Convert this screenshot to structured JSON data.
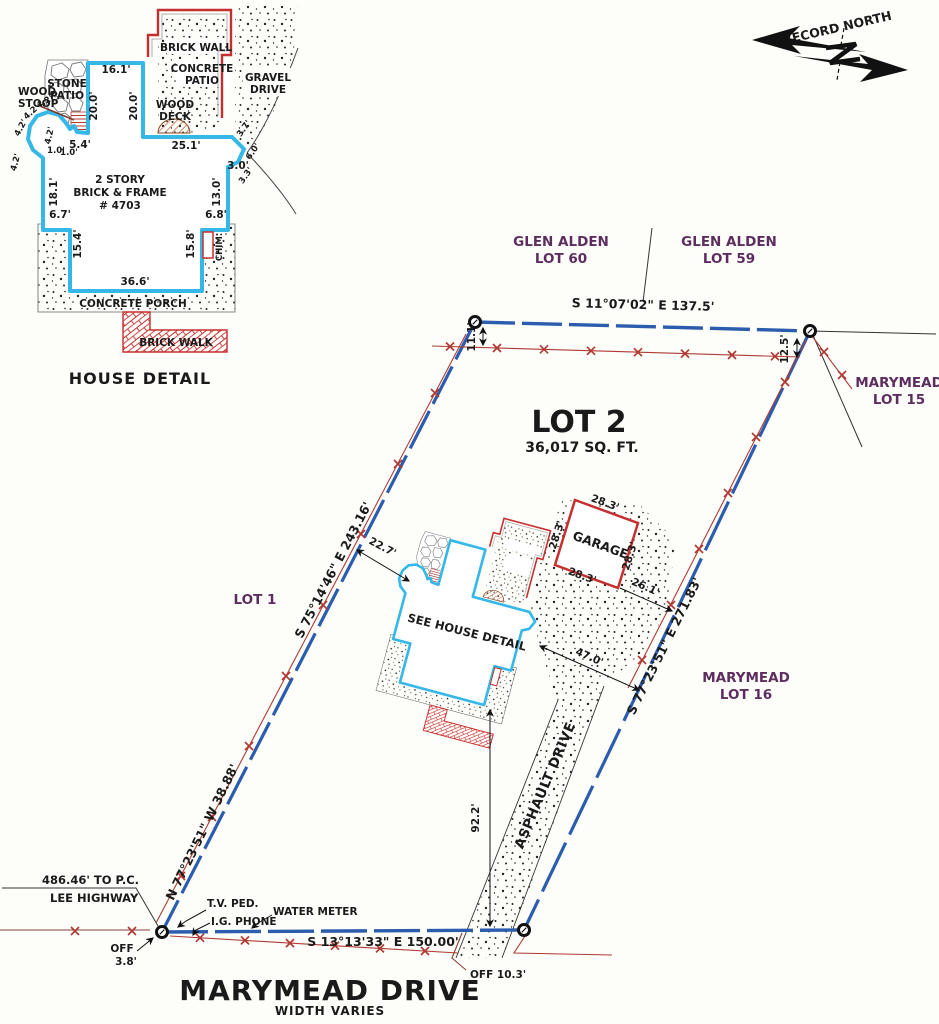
{
  "colors": {
    "boundary": "#2b5cad",
    "fence": "#b03a33",
    "house_outline": "#35b8e8",
    "brick": "#c62f2f",
    "lot_label": "#5c2d5e"
  },
  "hd": {
    "title": "HOUSE DETAIL",
    "brick_wall": "BRICK WALL",
    "concrete": "CONCRETE",
    "patio": "PATIO",
    "gravel": "GRAVEL",
    "drive": "DRIVE",
    "stone": "STONE",
    "wood": "WOOD",
    "stoop": "STOOP",
    "deck": "DECK",
    "porch": "CONCRETE PORCH",
    "walk": "BRICK WALK",
    "chim": "CHIM.",
    "story1": "2 STORY",
    "story2": "BRICK & FRAME",
    "story3": "# 4703",
    "d16": "16.1'",
    "d20": "20.0'",
    "d25": "25.1'",
    "d54": "5.4'",
    "d42": "4.2'",
    "d10": "1.0'",
    "d181": "18.1'",
    "d130": "13.0'",
    "d30": "3.0'",
    "d33": "3.3'",
    "d60": "6.0'",
    "d37": "3.7'",
    "d67": "6.7'",
    "d68": "6.8'",
    "d154": "15.4'",
    "d158": "15.8'",
    "d366": "36.6'"
  },
  "north": {
    "label": "RECORD NORTH"
  },
  "plat": {
    "lot2": "LOT 2",
    "area": "36,017 SQ. FT.",
    "lot1": "LOT 1",
    "glen": "GLEN ALDEN",
    "lot60": "LOT 60",
    "lot59": "LOT 59",
    "marymead": "MARYMEAD",
    "lot15": "LOT 15",
    "lot16": "LOT 16",
    "b_north": "S 11°07'02\" E 137.5'",
    "b_west": "S 75°14'46\" E 243.16'",
    "b_west2": "N 77°23'51\" W 38.88'",
    "b_east": "S 77°23'51\" E 271.83'",
    "b_south": "S 13°13'33\" E 150.00'",
    "d111": "11.1'",
    "d125": "12.5'",
    "d227": "22.7'",
    "d470": "47.0'",
    "d261": "26.1'",
    "d922": "92.2'",
    "garage": "GARAGE",
    "g283": "28.3'",
    "see_house": "SEE HOUSE DETAIL",
    "asphault": "ASPHAULT DRIVE",
    "tv": "T.V. PED.",
    "ig": "I.G. PHONE",
    "wm": "WATER METER",
    "pc": "486.46' TO P.C.",
    "lee": "LEE HIGHWAY",
    "off1": "OFF",
    "off1v": "3.8'",
    "off2": "OFF 10.3'"
  },
  "street": {
    "name": "MARYMEAD DRIVE",
    "width": "WIDTH VARIES"
  }
}
